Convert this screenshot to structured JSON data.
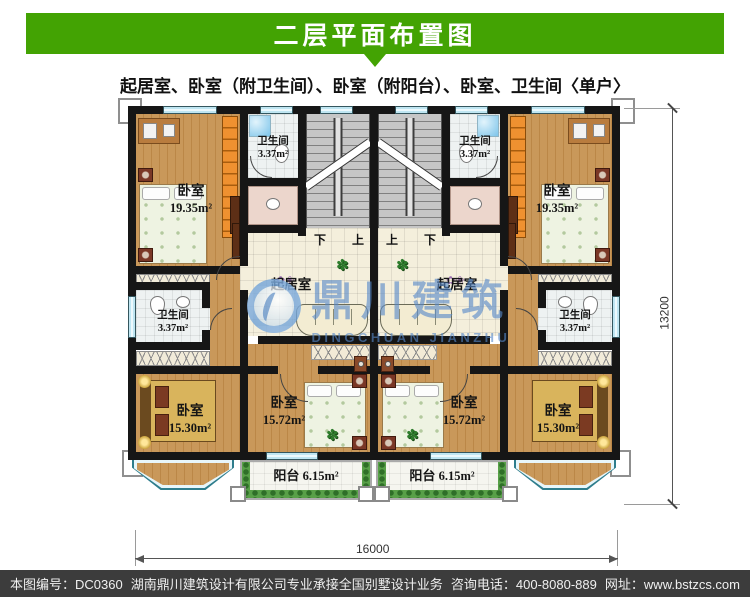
{
  "header": {
    "title": "二层平面布置图"
  },
  "subtitle": "起居室、卧室（附卫生间）、卧室（附阳台）、卧室、卫生间〈单户〉",
  "watermark": {
    "cn": "鼎川建筑",
    "en": "DINGCHUAN JIANZHU"
  },
  "plan": {
    "rooms": {
      "bedroom_tl": {
        "name": "卧室",
        "area": "19.35m²"
      },
      "bedroom_tr": {
        "name": "卧室",
        "area": "19.35m²"
      },
      "bath_tl": {
        "name": "卫生间",
        "area": "3.37m²"
      },
      "bath_tr": {
        "name": "卫生间",
        "area": "3.37m²"
      },
      "bath_ml": {
        "name": "卫生间",
        "area": "3.37m²"
      },
      "bath_mr": {
        "name": "卫生间",
        "area": "3.37m²"
      },
      "living_l": {
        "name": "起居室"
      },
      "living_r": {
        "name": "起居室"
      },
      "bedroom_bl": {
        "name": "卧室",
        "area": "15.30m²"
      },
      "bedroom_bcl": {
        "name": "卧室",
        "area": "15.72m²"
      },
      "bedroom_bcr": {
        "name": "卧室",
        "area": "15.72m²"
      },
      "bedroom_br": {
        "name": "卧室",
        "area": "15.30m²"
      },
      "balcony_l": {
        "name": "阳台",
        "area": "6.15m²"
      },
      "balcony_r": {
        "name": "阳台",
        "area": "6.15m²"
      }
    },
    "stairs": {
      "left_down": "下",
      "left_up": "上",
      "right_up": "上",
      "right_down": "下"
    },
    "dimensions": {
      "bottom": "16000",
      "right": "13200"
    }
  },
  "footer": {
    "drawing_no": "本图编号：DC0360",
    "company": "湖南鼎川建筑设计有限公司专业承接全国别墅设计业务",
    "phone": "咨询电话：400-8080-889",
    "website": "网址：www.bstzcs.com"
  },
  "colors": {
    "banner_green": "#43a303",
    "watermark_blue": "#5587c8",
    "wood_floor": "#c9985a",
    "wall_black": "#161616",
    "window_cyan": "#bfe6f2",
    "footer_bg": "#3c3c3c"
  }
}
